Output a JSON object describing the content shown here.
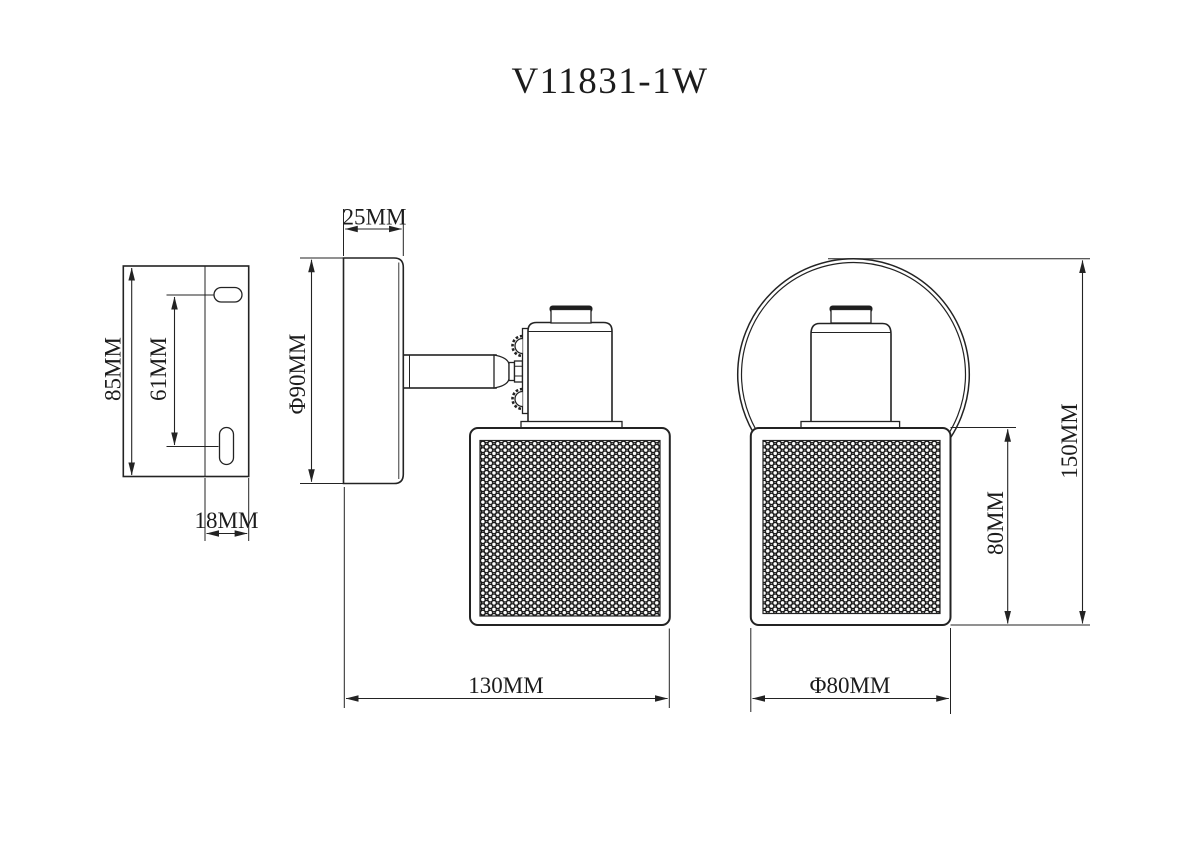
{
  "title": "V11831-1W",
  "labels": {
    "bracket_height": "85MM",
    "bracket_hole_spacing": "61MM",
    "bracket_width": "18MM",
    "canopy_depth": "25MM",
    "canopy_diameter": "Φ90MM",
    "total_projection": "130MM",
    "total_height": "150MM",
    "shade_height": "80MM",
    "shade_diameter": "Φ80MM"
  },
  "colors": {
    "background": "#ffffff",
    "line": "#232323",
    "mesh_ring": "#161616",
    "mesh_fill": "#ededeb"
  }
}
